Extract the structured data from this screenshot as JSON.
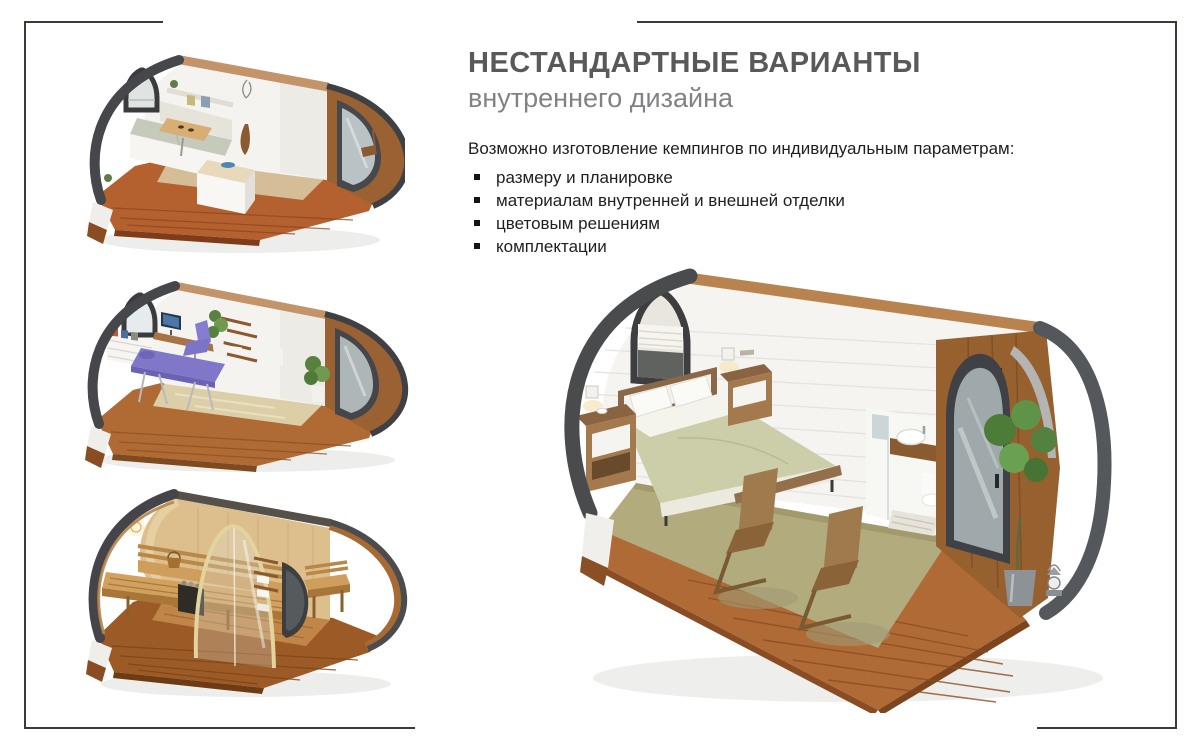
{
  "header": {
    "title": "НЕСТАНДАРТНЫЕ ВАРИАНТЫ",
    "subtitle": "внутреннего дизайна"
  },
  "body": {
    "intro": "Возможно изготовление кемпингов по индивидуальным параметрам:",
    "bullets": [
      "размеру и планировке",
      "материалам внутренней и внешней отделки",
      "цветовым решениям",
      "комплектации"
    ]
  },
  "palette": {
    "frame_line": "#3a3b33",
    "title_color": "#58595b",
    "subtitle_color": "#808285",
    "text_color": "#1f1f1f",
    "shell_dark": "#4a4b4d",
    "deck_wood": "#b06a35",
    "interior_wood": "#96602f",
    "carpet_green": "#b2ab7e",
    "bedding_sage": "#ccceaa",
    "accent_purple": "#8077c9",
    "sauna_wood": "#ddbf8d"
  },
  "gallery": {
    "items": [
      {
        "name": "office-lounge-pod-render"
      },
      {
        "name": "massage-salon-pod-render"
      },
      {
        "name": "sauna-pod-render"
      },
      {
        "name": "bedroom-bathroom-pod-render"
      }
    ]
  }
}
